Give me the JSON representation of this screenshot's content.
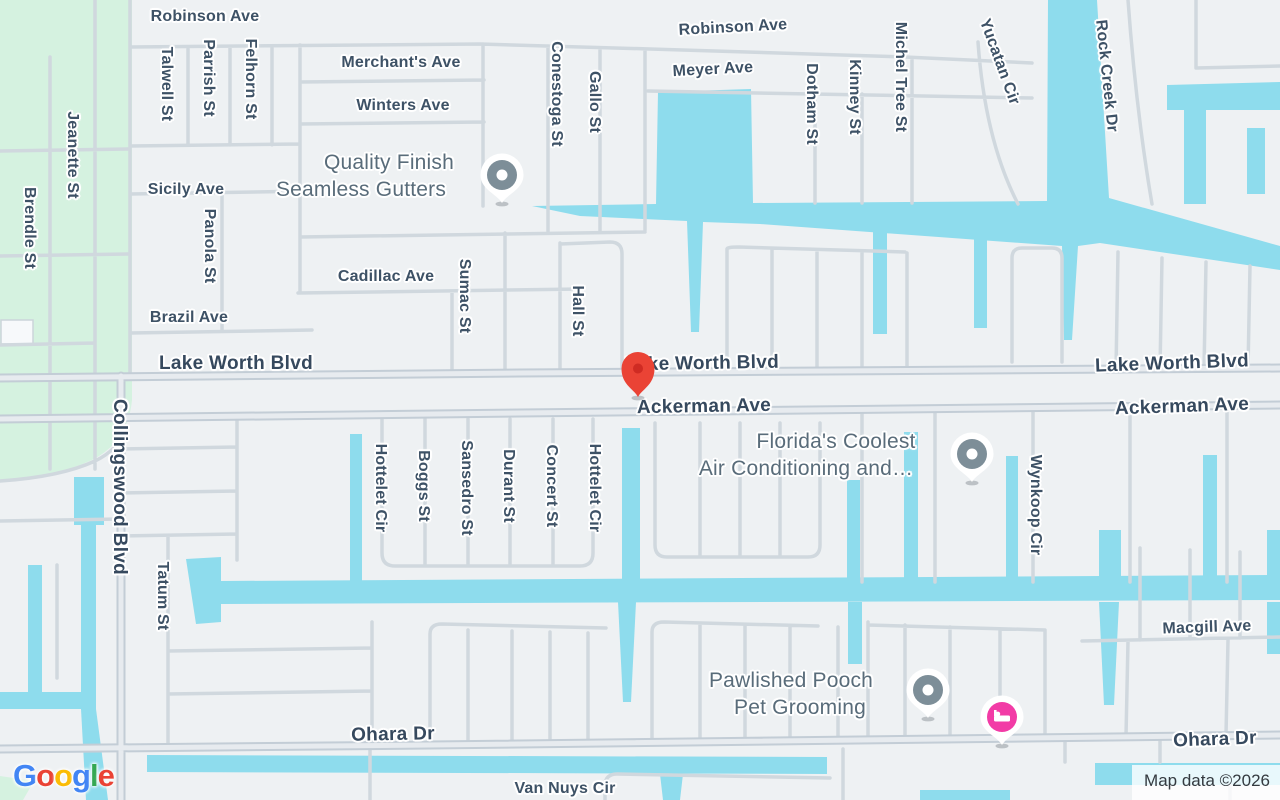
{
  "attribution": {
    "text": "Map data ©2026"
  },
  "google_logo": {
    "word": "Google",
    "letter_colors": [
      "#4285F4",
      "#EA4335",
      "#FBBC05",
      "#4285F4",
      "#34A853",
      "#EA4335"
    ]
  },
  "palette": {
    "land": "#eef1f3",
    "water": "#8edced",
    "park": "#d5f2e0",
    "road_minor": "#d0d8de",
    "road_major_casing": "#c3cdd6",
    "road_major_fill": "#e7ebef",
    "street_label": "#3e5266",
    "business_label": "#596c7a",
    "poi_pin": "#7d8e98",
    "hotel_pin": "#f23ba6",
    "destination_pin": "#EA4335"
  },
  "street_labels": [
    {
      "text": "Robinson Ave",
      "x": 205,
      "y": 17,
      "rot": 0,
      "kind": "minor"
    },
    {
      "text": "Robinson Ave",
      "x": 733,
      "y": 28,
      "rot": -3,
      "kind": "minor"
    },
    {
      "text": "Merchant's Ave",
      "x": 401,
      "y": 63,
      "rot": 0,
      "kind": "minor"
    },
    {
      "text": "Winters Ave",
      "x": 403,
      "y": 106,
      "rot": 0,
      "kind": "minor"
    },
    {
      "text": "Meyer Ave",
      "x": 713,
      "y": 70,
      "rot": -3,
      "kind": "minor"
    },
    {
      "text": "Sicily Ave",
      "x": 186,
      "y": 190,
      "rot": 0,
      "kind": "minor"
    },
    {
      "text": "Cadillac Ave",
      "x": 386,
      "y": 277,
      "rot": 0,
      "kind": "minor"
    },
    {
      "text": "Brazil Ave",
      "x": 189,
      "y": 318,
      "rot": 0,
      "kind": "minor"
    },
    {
      "text": "Lake Worth Blvd",
      "x": 236,
      "y": 364,
      "rot": 0,
      "kind": "major"
    },
    {
      "text": "Lake Worth Blvd",
      "x": 702,
      "y": 364,
      "rot": -1,
      "kind": "major"
    },
    {
      "text": "Lake Worth Blvd",
      "x": 1172,
      "y": 364,
      "rot": -2,
      "kind": "major"
    },
    {
      "text": "Ackerman Ave",
      "x": 704,
      "y": 407,
      "rot": -1,
      "kind": "major"
    },
    {
      "text": "Ackerman Ave",
      "x": 1182,
      "y": 407,
      "rot": -2,
      "kind": "major"
    },
    {
      "text": "Macgill Ave",
      "x": 1207,
      "y": 628,
      "rot": -2,
      "kind": "minor"
    },
    {
      "text": "Ohara Dr",
      "x": 393,
      "y": 735,
      "rot": -1,
      "kind": "major"
    },
    {
      "text": "Ohara Dr",
      "x": 1215,
      "y": 740,
      "rot": -2,
      "kind": "major"
    },
    {
      "text": "Van Nuys Cir",
      "x": 565,
      "y": 789,
      "rot": 0,
      "kind": "minor"
    },
    {
      "text": "Jeanette St",
      "x": 72,
      "y": 155,
      "rot": 90,
      "kind": "minor"
    },
    {
      "text": "Brendle St",
      "x": 29,
      "y": 228,
      "rot": 90,
      "kind": "minor"
    },
    {
      "text": "Talwell St",
      "x": 166,
      "y": 84,
      "rot": 90,
      "kind": "minor"
    },
    {
      "text": "Parrish St",
      "x": 208,
      "y": 78,
      "rot": 90,
      "kind": "minor"
    },
    {
      "text": "Felhorn St",
      "x": 250,
      "y": 79,
      "rot": 90,
      "kind": "minor"
    },
    {
      "text": "Panola St",
      "x": 209,
      "y": 246,
      "rot": 90,
      "kind": "minor"
    },
    {
      "text": "Conestoga St",
      "x": 556,
      "y": 94,
      "rot": 90,
      "kind": "minor"
    },
    {
      "text": "Gallo St",
      "x": 594,
      "y": 102,
      "rot": 90,
      "kind": "minor"
    },
    {
      "text": "Dotham St",
      "x": 811,
      "y": 104,
      "rot": 90,
      "kind": "minor"
    },
    {
      "text": "Kinney St",
      "x": 854,
      "y": 97,
      "rot": 90,
      "kind": "minor"
    },
    {
      "text": "Michel Tree St",
      "x": 900,
      "y": 77,
      "rot": 90,
      "kind": "minor"
    },
    {
      "text": "Yucatan Cir",
      "x": 999,
      "y": 62,
      "rot": 70,
      "kind": "minor"
    },
    {
      "text": "Rock Creek Dr",
      "x": 1106,
      "y": 76,
      "rot": 84,
      "kind": "minor"
    },
    {
      "text": "Sumac St",
      "x": 464,
      "y": 296,
      "rot": 90,
      "kind": "minor"
    },
    {
      "text": "Hall St",
      "x": 577,
      "y": 311,
      "rot": 90,
      "kind": "minor"
    },
    {
      "text": "Collingswood Blvd",
      "x": 119,
      "y": 487,
      "rot": 90,
      "kind": "major"
    },
    {
      "text": "Tatum St",
      "x": 162,
      "y": 596,
      "rot": 90,
      "kind": "minor"
    },
    {
      "text": "Hottelet Cir",
      "x": 380,
      "y": 488,
      "rot": 90,
      "kind": "minor"
    },
    {
      "text": "Boggs St",
      "x": 423,
      "y": 486,
      "rot": 90,
      "kind": "minor"
    },
    {
      "text": "Sansedro St",
      "x": 466,
      "y": 488,
      "rot": 90,
      "kind": "minor"
    },
    {
      "text": "Durant St",
      "x": 508,
      "y": 486,
      "rot": 90,
      "kind": "minor"
    },
    {
      "text": "Concert St",
      "x": 551,
      "y": 486,
      "rot": 90,
      "kind": "minor"
    },
    {
      "text": "Hottelet Cir",
      "x": 594,
      "y": 488,
      "rot": 90,
      "kind": "minor"
    },
    {
      "text": "Wynkoop Cir",
      "x": 1035,
      "y": 505,
      "rot": 90,
      "kind": "minor"
    }
  ],
  "business_labels": [
    {
      "text": "Quality Finish",
      "x": 389,
      "y": 163
    },
    {
      "text": "Seamless Gutters",
      "x": 361,
      "y": 190
    },
    {
      "text": "Florida's Coolest",
      "x": 836,
      "y": 442
    },
    {
      "text": "Air Conditioning and…",
      "x": 806,
      "y": 469
    },
    {
      "text": "Pawlished Pooch",
      "x": 791,
      "y": 681
    },
    {
      "text": "Pet Grooming",
      "x": 800,
      "y": 708
    }
  ],
  "pins": [
    {
      "type": "poi",
      "x": 502,
      "y": 203,
      "business": "Quality Finish Seamless Gutters"
    },
    {
      "type": "poi",
      "x": 972,
      "y": 482,
      "business": "Florida's Coolest Air Conditioning and…"
    },
    {
      "type": "poi",
      "x": 928,
      "y": 718,
      "business": "Pawlished Pooch Pet Grooming"
    },
    {
      "type": "hotel",
      "x": 1002,
      "y": 745
    },
    {
      "type": "destination",
      "x": 638,
      "y": 397
    }
  ]
}
